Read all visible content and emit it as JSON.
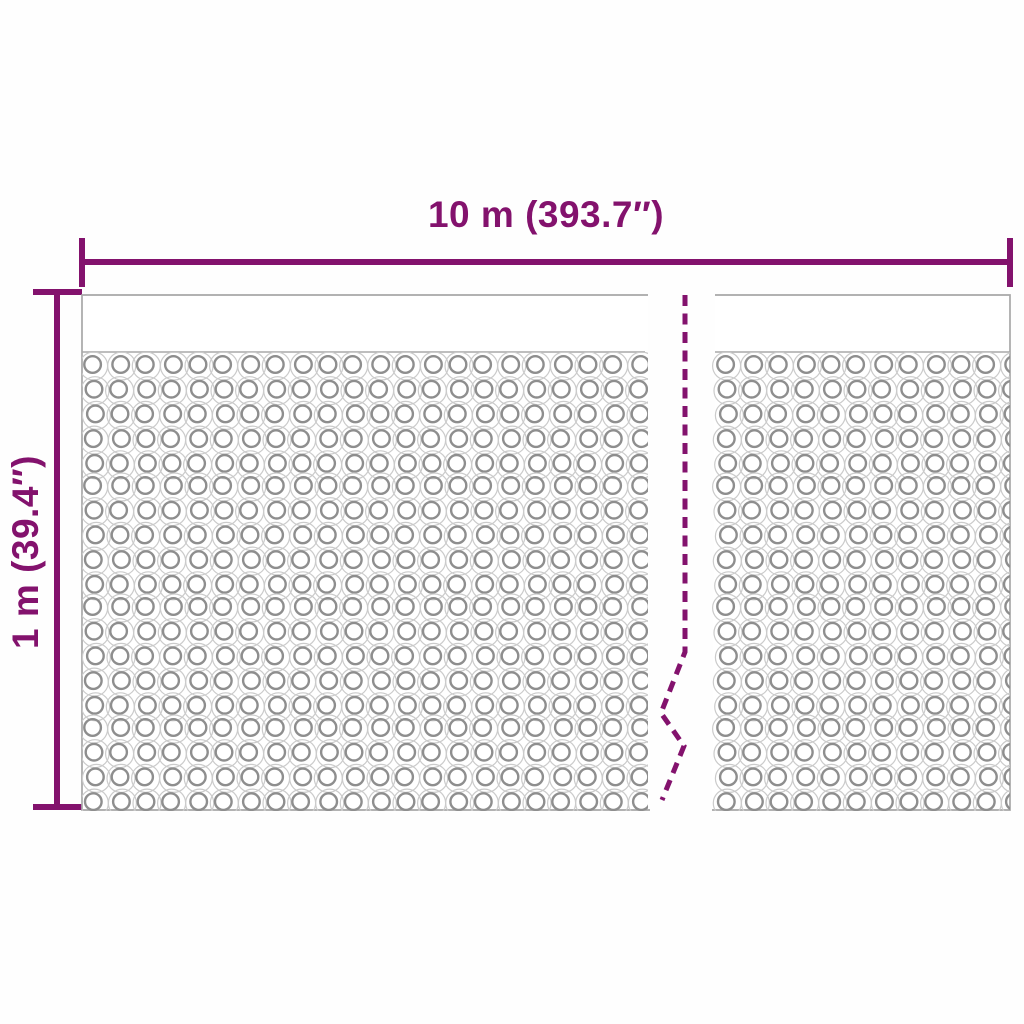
{
  "diagram": {
    "width_label": "10 m (393.7″)",
    "height_label": "1 m (39.4″)",
    "colors": {
      "accent": "#83126D",
      "panel_outline": "#A8A8A8",
      "bubble_outer": "#CBCBCB",
      "bubble_inner": "#8E8E8E",
      "background": "#FEFEFE"
    }
  }
}
